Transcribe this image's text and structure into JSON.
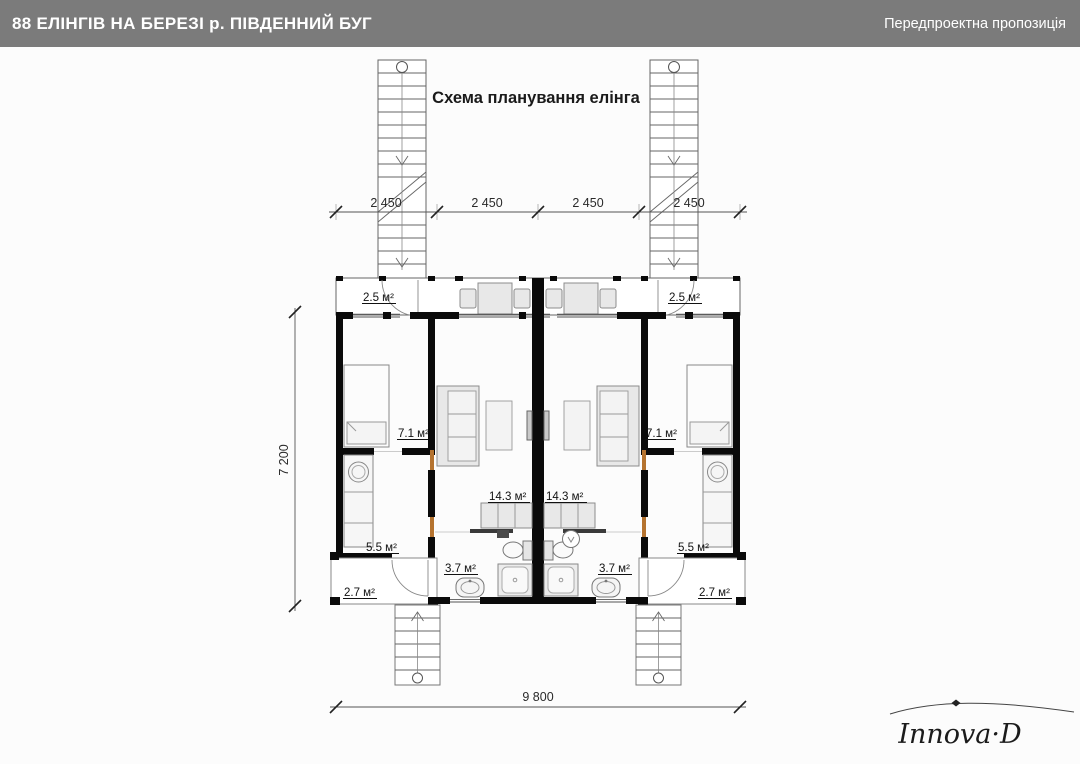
{
  "header": {
    "title": "88 ЕЛІНГІВ НА БЕРЕЗІ р. ПІВДЕННИЙ БУГ",
    "subtitle": "Передпроектна пропозиція"
  },
  "plan": {
    "title": "Схема планування елінга",
    "dims": {
      "top": [
        "2 450",
        "2 450",
        "2 450",
        "2 450"
      ],
      "left": "7 200",
      "bottom": "9 800"
    },
    "labels": {
      "terrace_left": "2.5 м²",
      "terrace_right": "2.5 м²",
      "bedroom_left": "7.1 м²",
      "bedroom_right": "7.1 м²",
      "storage_left": "5.5 м²",
      "storage_right": "5.5 м²",
      "living_left": "14.3 м²",
      "living_right": "14.3 м²",
      "bath_left": "3.7 м²",
      "bath_right": "3.7 м²",
      "porch_left": "2.7 м²",
      "porch_right": "2.7 м²"
    }
  },
  "logo": {
    "text": "Innova·D"
  },
  "colors": {
    "header_bg": "#7b7b7b",
    "header_text": "#ffffff",
    "wall": "#0a0a0a",
    "wood_accent": "#b5732f",
    "furniture_fill": "#e8e8e8",
    "line": "#555555"
  }
}
